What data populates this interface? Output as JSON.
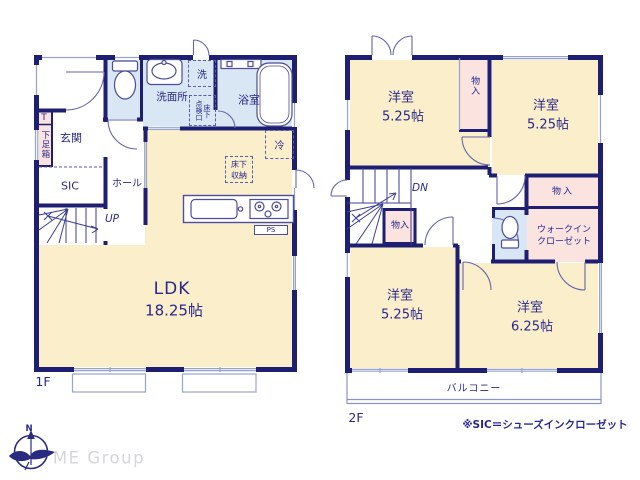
{
  "plan": {
    "f1": {
      "floor_label": "1F",
      "labels": {
        "genkan": "玄関",
        "shoebox_t": "T",
        "shoebox": "下足箱",
        "sic": "SIC",
        "hall": "ホール",
        "up": "UP",
        "washroom": "洗面所",
        "washer": "洗",
        "hatch_left_col": "点検口",
        "hatch_right_col": "床下",
        "bath": "浴室",
        "fridge": "冷",
        "underfloor_l1": "床下",
        "underfloor_l2": "収納",
        "ldk": "LDK",
        "ldk_size": "18.25帖",
        "ps": "PS"
      }
    },
    "f2": {
      "floor_label": "2F",
      "labels": {
        "room_nw": "洋室",
        "room_nw_size": "5.25帖",
        "room_ne": "洋室",
        "room_ne_size": "5.25帖",
        "room_sw": "洋室",
        "room_sw_size": "5.25帖",
        "room_se": "洋室",
        "room_se_size": "6.25帖",
        "closet_top": "物入",
        "closet_east": "物入",
        "closet_stair": "物入",
        "wic_l1": "ウォークイン",
        "wic_l2": "クローゼット",
        "dn": "DN",
        "balcony": "バルコニー"
      }
    },
    "note": "※SIC＝シューズインクローゼット",
    "compass_n": "N",
    "brand": "ME Group"
  },
  "colors": {
    "wall": "#1e1e73",
    "text": "#28288c",
    "room_cream": "#fbeecb",
    "room_pink": "#fbe3e0",
    "room_blue": "#d9e6f3",
    "window_line": "#97a3c9",
    "brand_gray": "#d6d6da"
  }
}
